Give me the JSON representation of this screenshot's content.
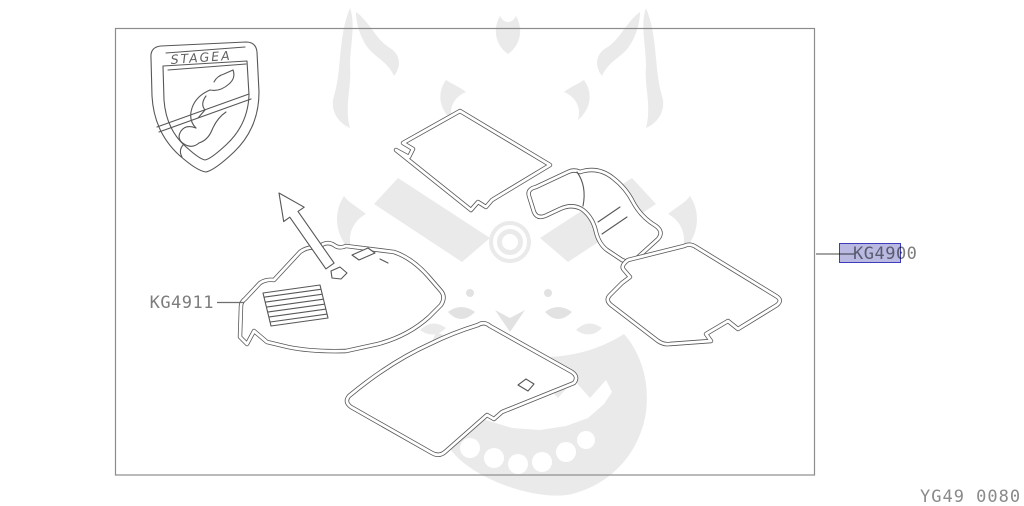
{
  "diagram": {
    "badge": {
      "text": "STAGEA"
    },
    "labels": {
      "kg4911": "KG4911",
      "kg4900": "KG4900"
    },
    "selected_part": "KG4900",
    "sheet_code": "YG49 0080",
    "colors": {
      "line_art": "#575757",
      "frame_border": "#8c8c8c",
      "label_text": "#7d7d7d",
      "sheet_code_text": "#8a8a8a",
      "highlight_fill": "#b9b9e2",
      "highlight_border": "#3d3dbb",
      "watermark": "#eaeaea",
      "background": "#ffffff"
    },
    "icons": {
      "direction_arrow": "front-direction-arrow",
      "watermark_motif": "oni-mask-watermark"
    }
  }
}
